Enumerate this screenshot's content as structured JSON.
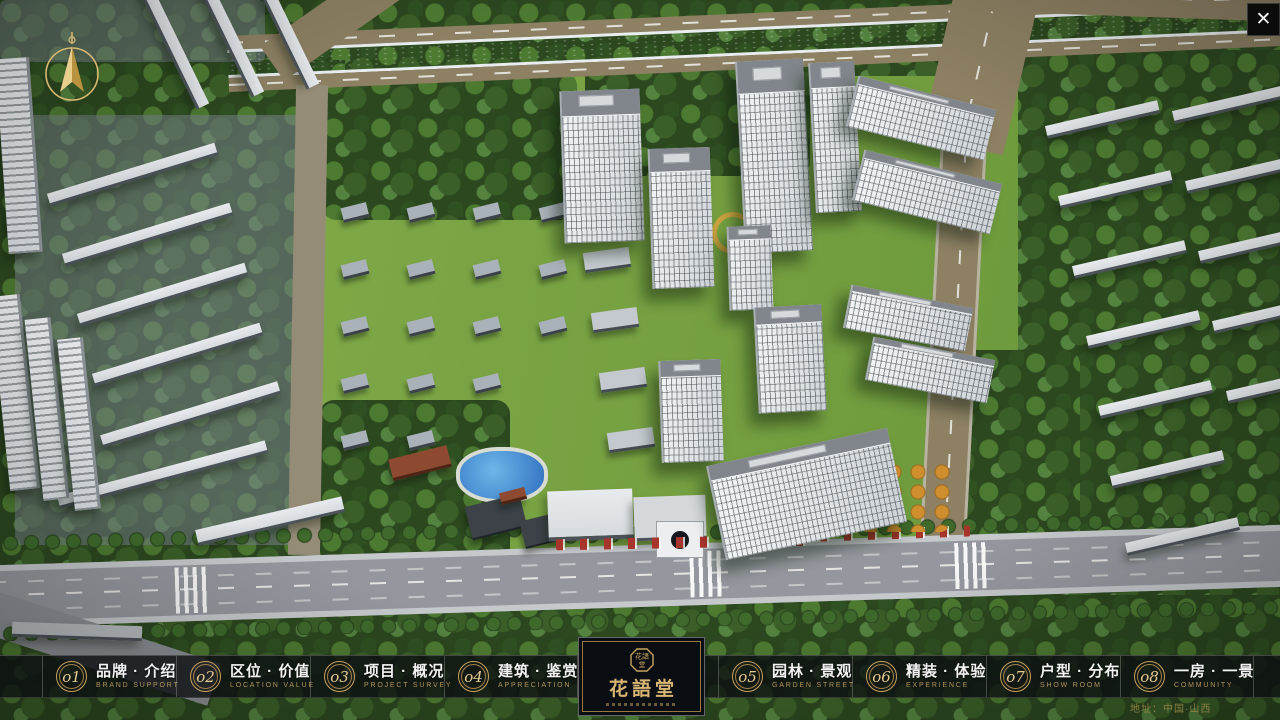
{
  "window": {
    "close_label": "✕"
  },
  "nav": {
    "items": [
      {
        "num": "o1",
        "zh": "品牌 · 介绍",
        "en": "BRAND SUPPORT"
      },
      {
        "num": "o2",
        "zh": "区位 · 价值",
        "en": "LOCATION VALUE"
      },
      {
        "num": "o3",
        "zh": "项目 · 概况",
        "en": "PROJECT SURVEY"
      },
      {
        "num": "o4",
        "zh": "建筑 · 鉴赏",
        "en": "APPRECIATION"
      },
      {
        "num": "o5",
        "zh": "园林 · 景观",
        "en": "GARDEN STREET"
      },
      {
        "num": "o6",
        "zh": "精装 · 体验",
        "en": "EXPERIENCE"
      },
      {
        "num": "o7",
        "zh": "户型 · 分布",
        "en": "SHOW ROOM"
      },
      {
        "num": "o8",
        "zh": "一房 · 一景",
        "en": "COMMUNITY"
      }
    ]
  },
  "logo": {
    "title": "花語堂",
    "seal_text": "花語堂"
  },
  "footer": {
    "address": "地址：中国·山西"
  },
  "colors": {
    "accent_gold": "#c9a35f",
    "bar_bg": "rgba(12,15,18,0.80)",
    "river_blue": "#2f63cd"
  }
}
